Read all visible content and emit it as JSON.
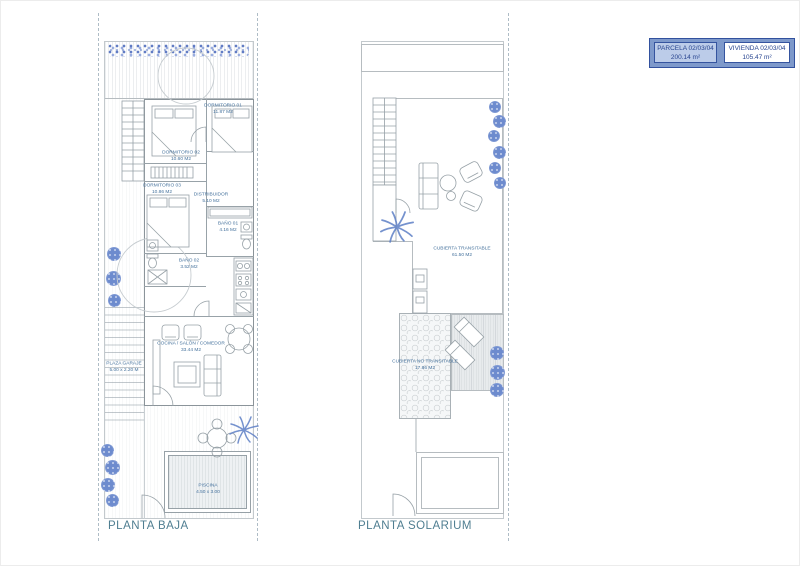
{
  "legend": {
    "parcela": {
      "label": "PARCELA 02/03/04",
      "area": "200.14 m²"
    },
    "vivienda": {
      "label": "VIVIENDA 02/03/04",
      "area": "105.47 m²"
    }
  },
  "plans": {
    "planta_baja": {
      "title": "PLANTA BAJA",
      "rooms": [
        {
          "name": "DORMITORIO 01",
          "area": "11.87 M2"
        },
        {
          "name": "DORMITORIO 02",
          "area": "10.60 M2"
        },
        {
          "name": "DORMITORIO 03",
          "area": "10.86 M2"
        },
        {
          "name": "DISTRIBUIDOR",
          "area": "5.10 M2"
        },
        {
          "name": "BAÑO 01",
          "area": "4.16 M2"
        },
        {
          "name": "BAÑO 02",
          "area": "3.52 M2"
        },
        {
          "name": "COCINA / SALÓN / COMEDOR",
          "area": "33.44 M2"
        },
        {
          "name": "PLAZA GARAJE",
          "area": "5.00 x 2.20 M"
        },
        {
          "name": "PISCINA",
          "area": "4.50 x 3.00"
        }
      ]
    },
    "planta_solarium": {
      "title": "PLANTA SOLARIUM",
      "rooms": [
        {
          "name": "CUBIERTA TRANSITABLE",
          "area": "61.50 M2"
        },
        {
          "name": "CUBIERTA NO TRANSITABLE",
          "area": "17.86 M2"
        }
      ]
    }
  },
  "colors": {
    "accent_blue": "#32519e",
    "legend_fill": "#7e99cb",
    "legend_cell_bg": "#bccce9",
    "label_blue": "#44719c",
    "title_teal": "#4f7e91",
    "plant_blue": "#5d7fc6",
    "wall_gray": "#8b949a"
  }
}
